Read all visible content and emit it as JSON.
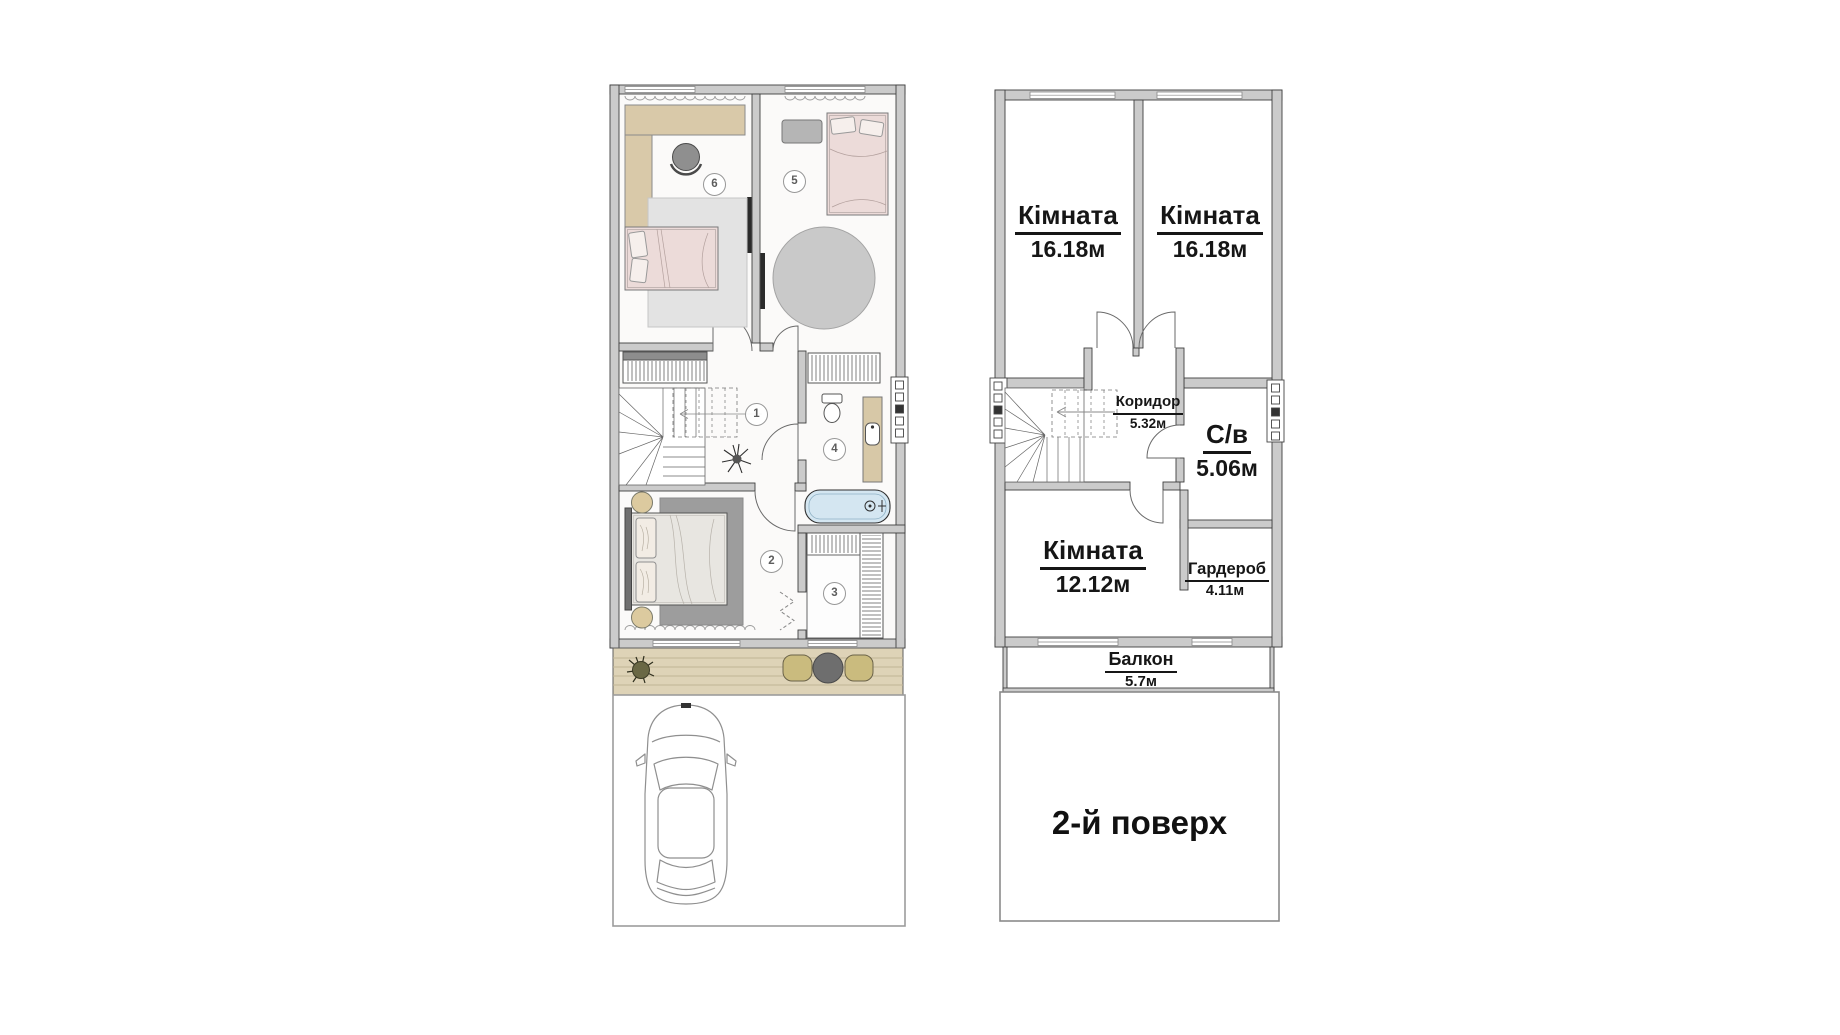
{
  "left_plan": {
    "markers": [
      "1",
      "2",
      "3",
      "4",
      "5",
      "6"
    ]
  },
  "right_plan": {
    "rooms": [
      {
        "name": "Кімната",
        "area": "16.18м"
      },
      {
        "name": "Кімната",
        "area": "16.18м"
      },
      {
        "name": "Коридор",
        "area": "5.32м"
      },
      {
        "name": "С/в",
        "area": "5.06м"
      },
      {
        "name": "Кімната",
        "area": "12.12м"
      },
      {
        "name": "Гардероб",
        "area": "4.11м"
      },
      {
        "name": "Балкон",
        "area": "5.7м"
      }
    ],
    "floor_label": "2-й поверх"
  },
  "colors": {
    "wall_fill": "#cbcbcb",
    "wall_edge": "#3f3f3f",
    "label_text": "#161616",
    "bed_pink": "#ecdbd9",
    "desk_tan": "#d9c9a9",
    "tub_blue": "#d4e6f1",
    "deck_tan": "#ded3b7",
    "rug_gray": "#9d9d9d"
  }
}
